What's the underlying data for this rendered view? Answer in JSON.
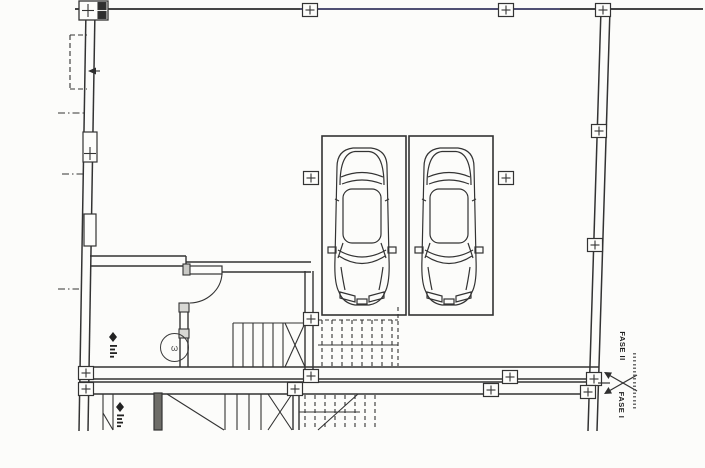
{
  "plan": {
    "labels": {
      "phase_upper": "FASE II",
      "phase_lower": "FASE I"
    },
    "symbols": {
      "circle_glyph": "ω"
    },
    "inventory": {
      "parking_spaces": 2,
      "cars": 2,
      "column_markers": 16
    },
    "colors": {
      "line": "#333333",
      "background": "#fcfcfa",
      "scan_tint_blue": "#6060b0"
    }
  }
}
